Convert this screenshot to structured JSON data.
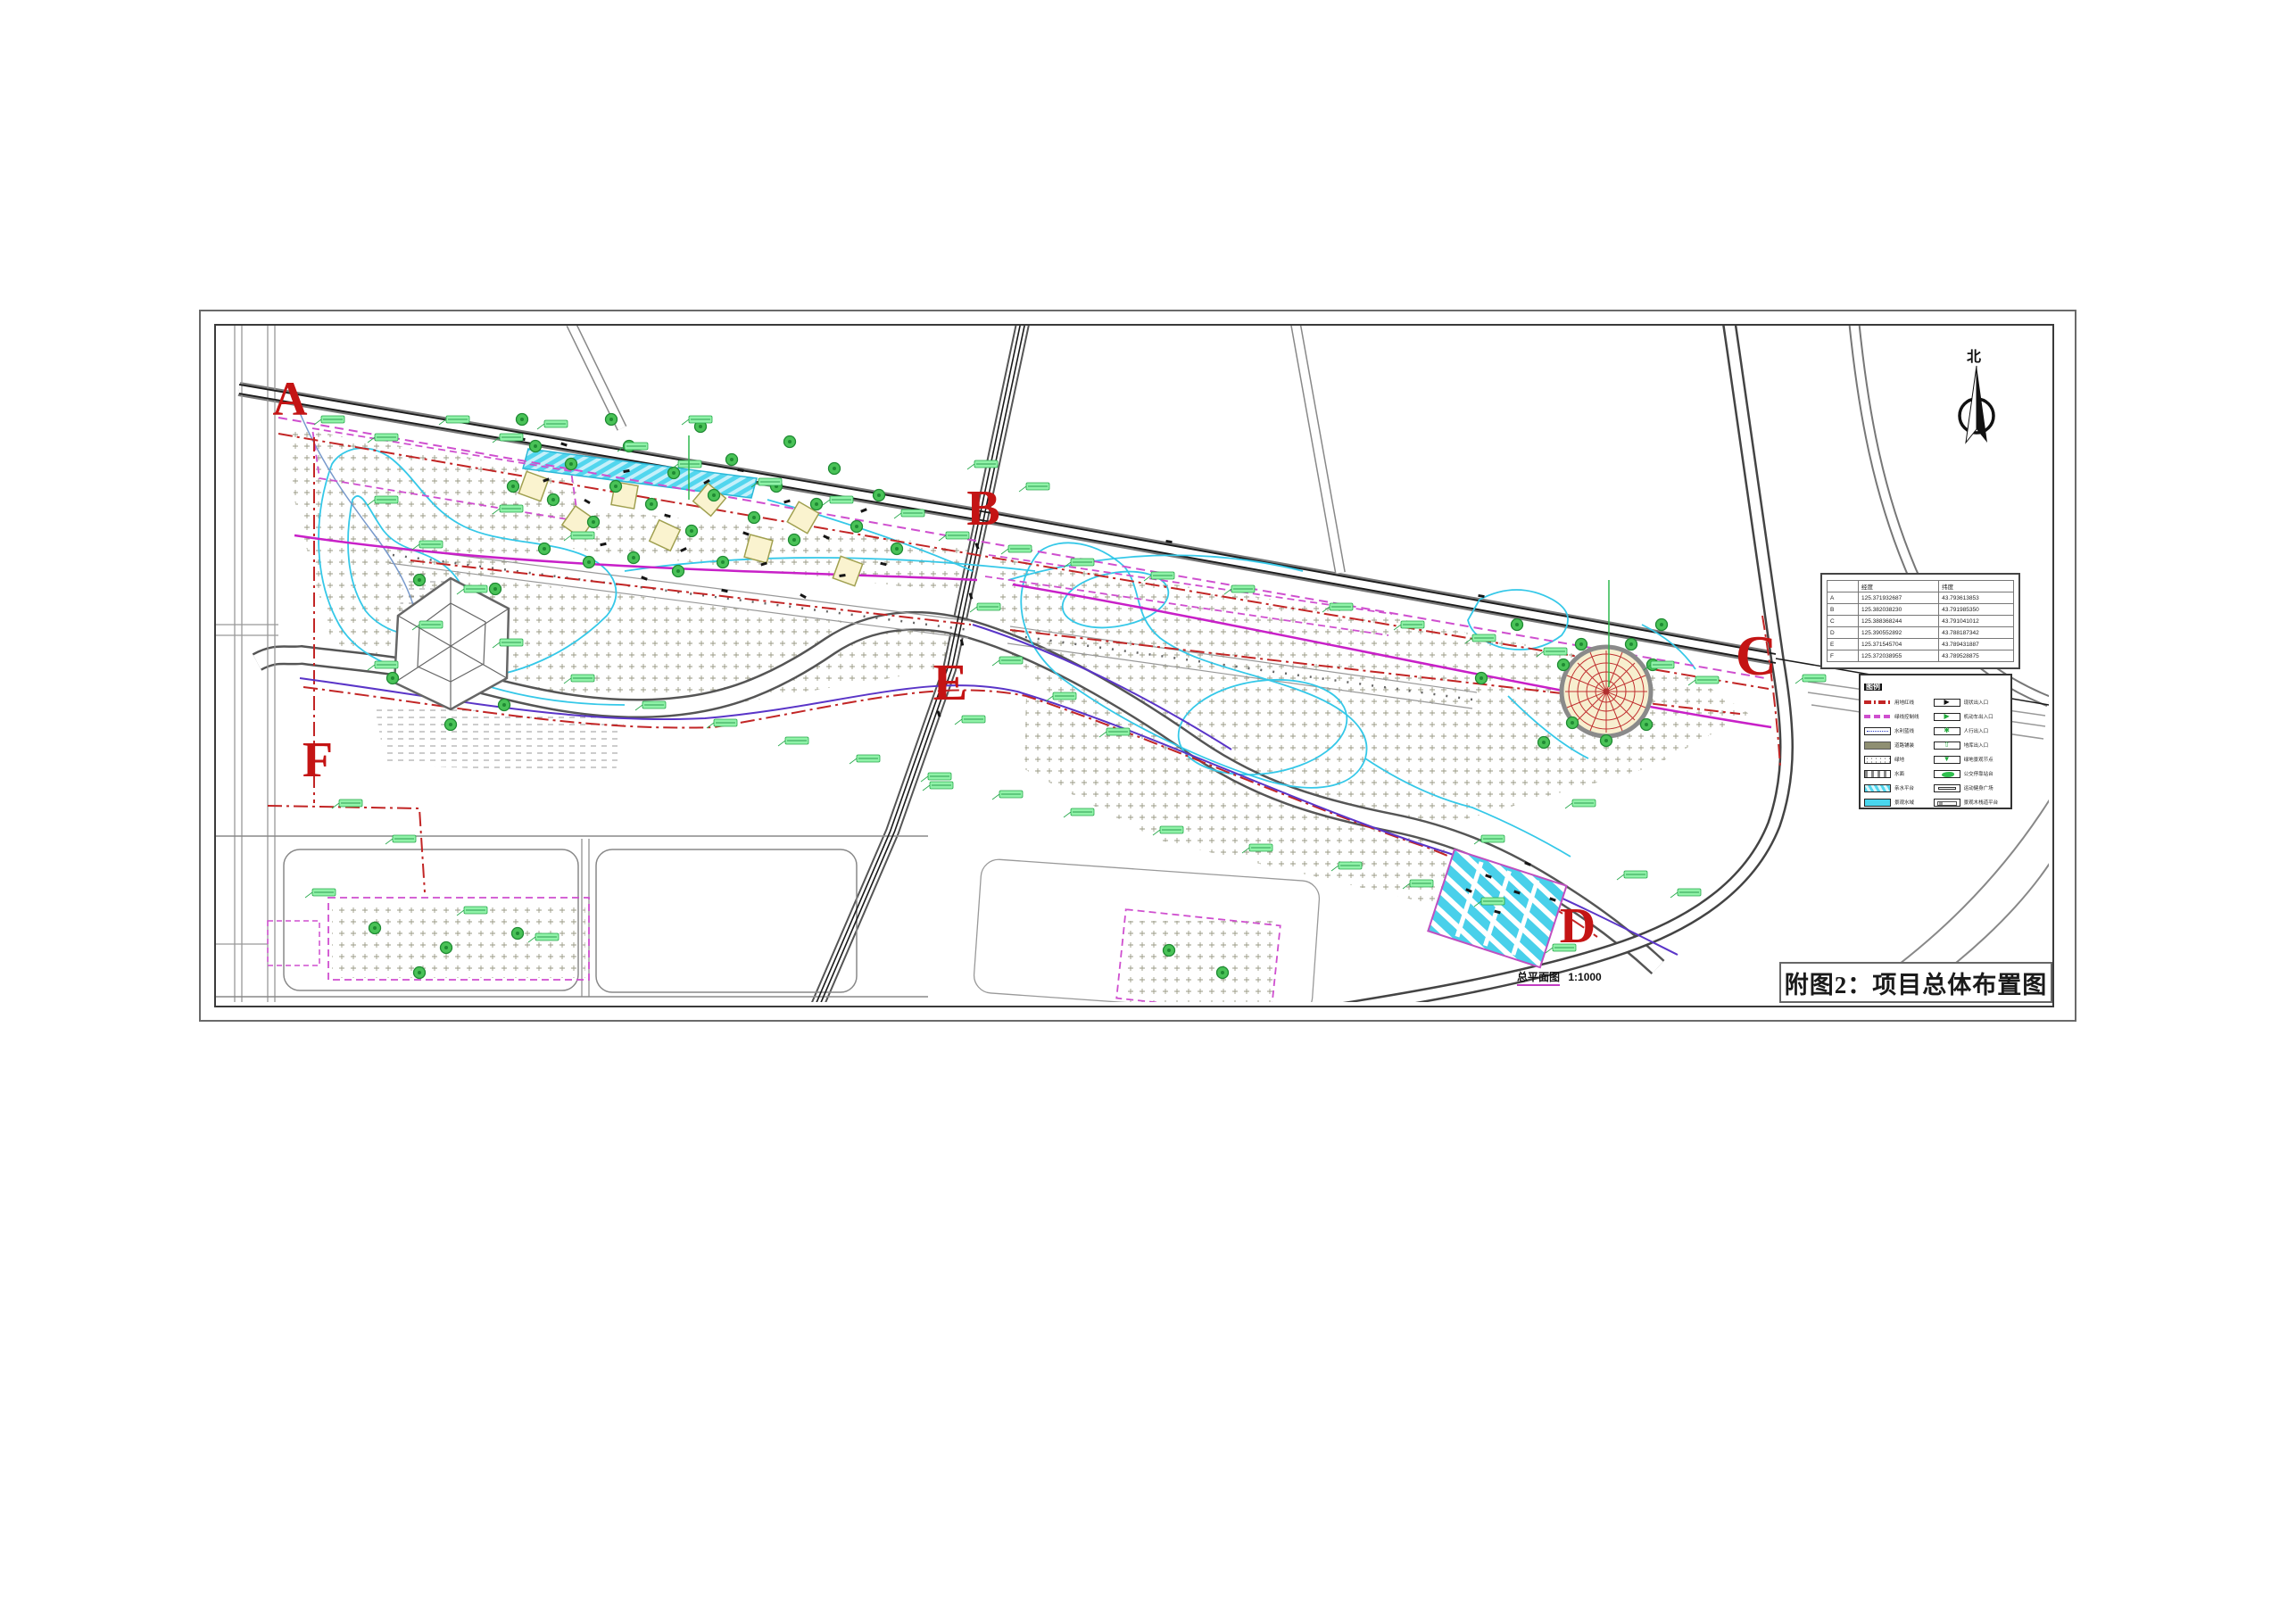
{
  "sheet": {
    "title": "附图2：项目总体布置图",
    "plan_label": "总平面图",
    "plan_scale": "1:1000",
    "north_label": "北"
  },
  "markers": {
    "a": "A",
    "b": "B",
    "c": "C",
    "d": "D",
    "e": "E",
    "f": "F"
  },
  "coordinate_table": {
    "headers": [
      "",
      "经度",
      "纬度"
    ],
    "rows": [
      [
        "A",
        "125.371932687",
        "43.793613853"
      ],
      [
        "B",
        "125.382038230",
        "43.791985350"
      ],
      [
        "C",
        "125.388368244",
        "43.791041012"
      ],
      [
        "D",
        "125.390552892",
        "43.788187342"
      ],
      [
        "E",
        "125.371545704",
        "43.789431887"
      ],
      [
        "F",
        "125.372038955",
        "43.789528875"
      ]
    ]
  },
  "legend": {
    "title": "图例",
    "left_items": [
      "用地红线",
      "绿线控制线",
      "水利蓝线",
      "道路铺装",
      "绿地",
      "水面",
      "亲水平台",
      "景观水域"
    ],
    "right_items": [
      "现状出入口",
      "机动车出入口",
      "人行出入口",
      "地库出入口",
      "绿地景观节点",
      "公交停靠站台",
      "运动健身广场",
      "景观木栈道平台"
    ]
  },
  "colors": {
    "marker_red": "#c41414",
    "boundary_red": "#c22525",
    "green_line": "#cf4fcf",
    "water_cyan": "#49d6ee",
    "path_cyan": "#35c8e8",
    "tag_green": "#90f2a8",
    "purple": "#5a35c8"
  }
}
